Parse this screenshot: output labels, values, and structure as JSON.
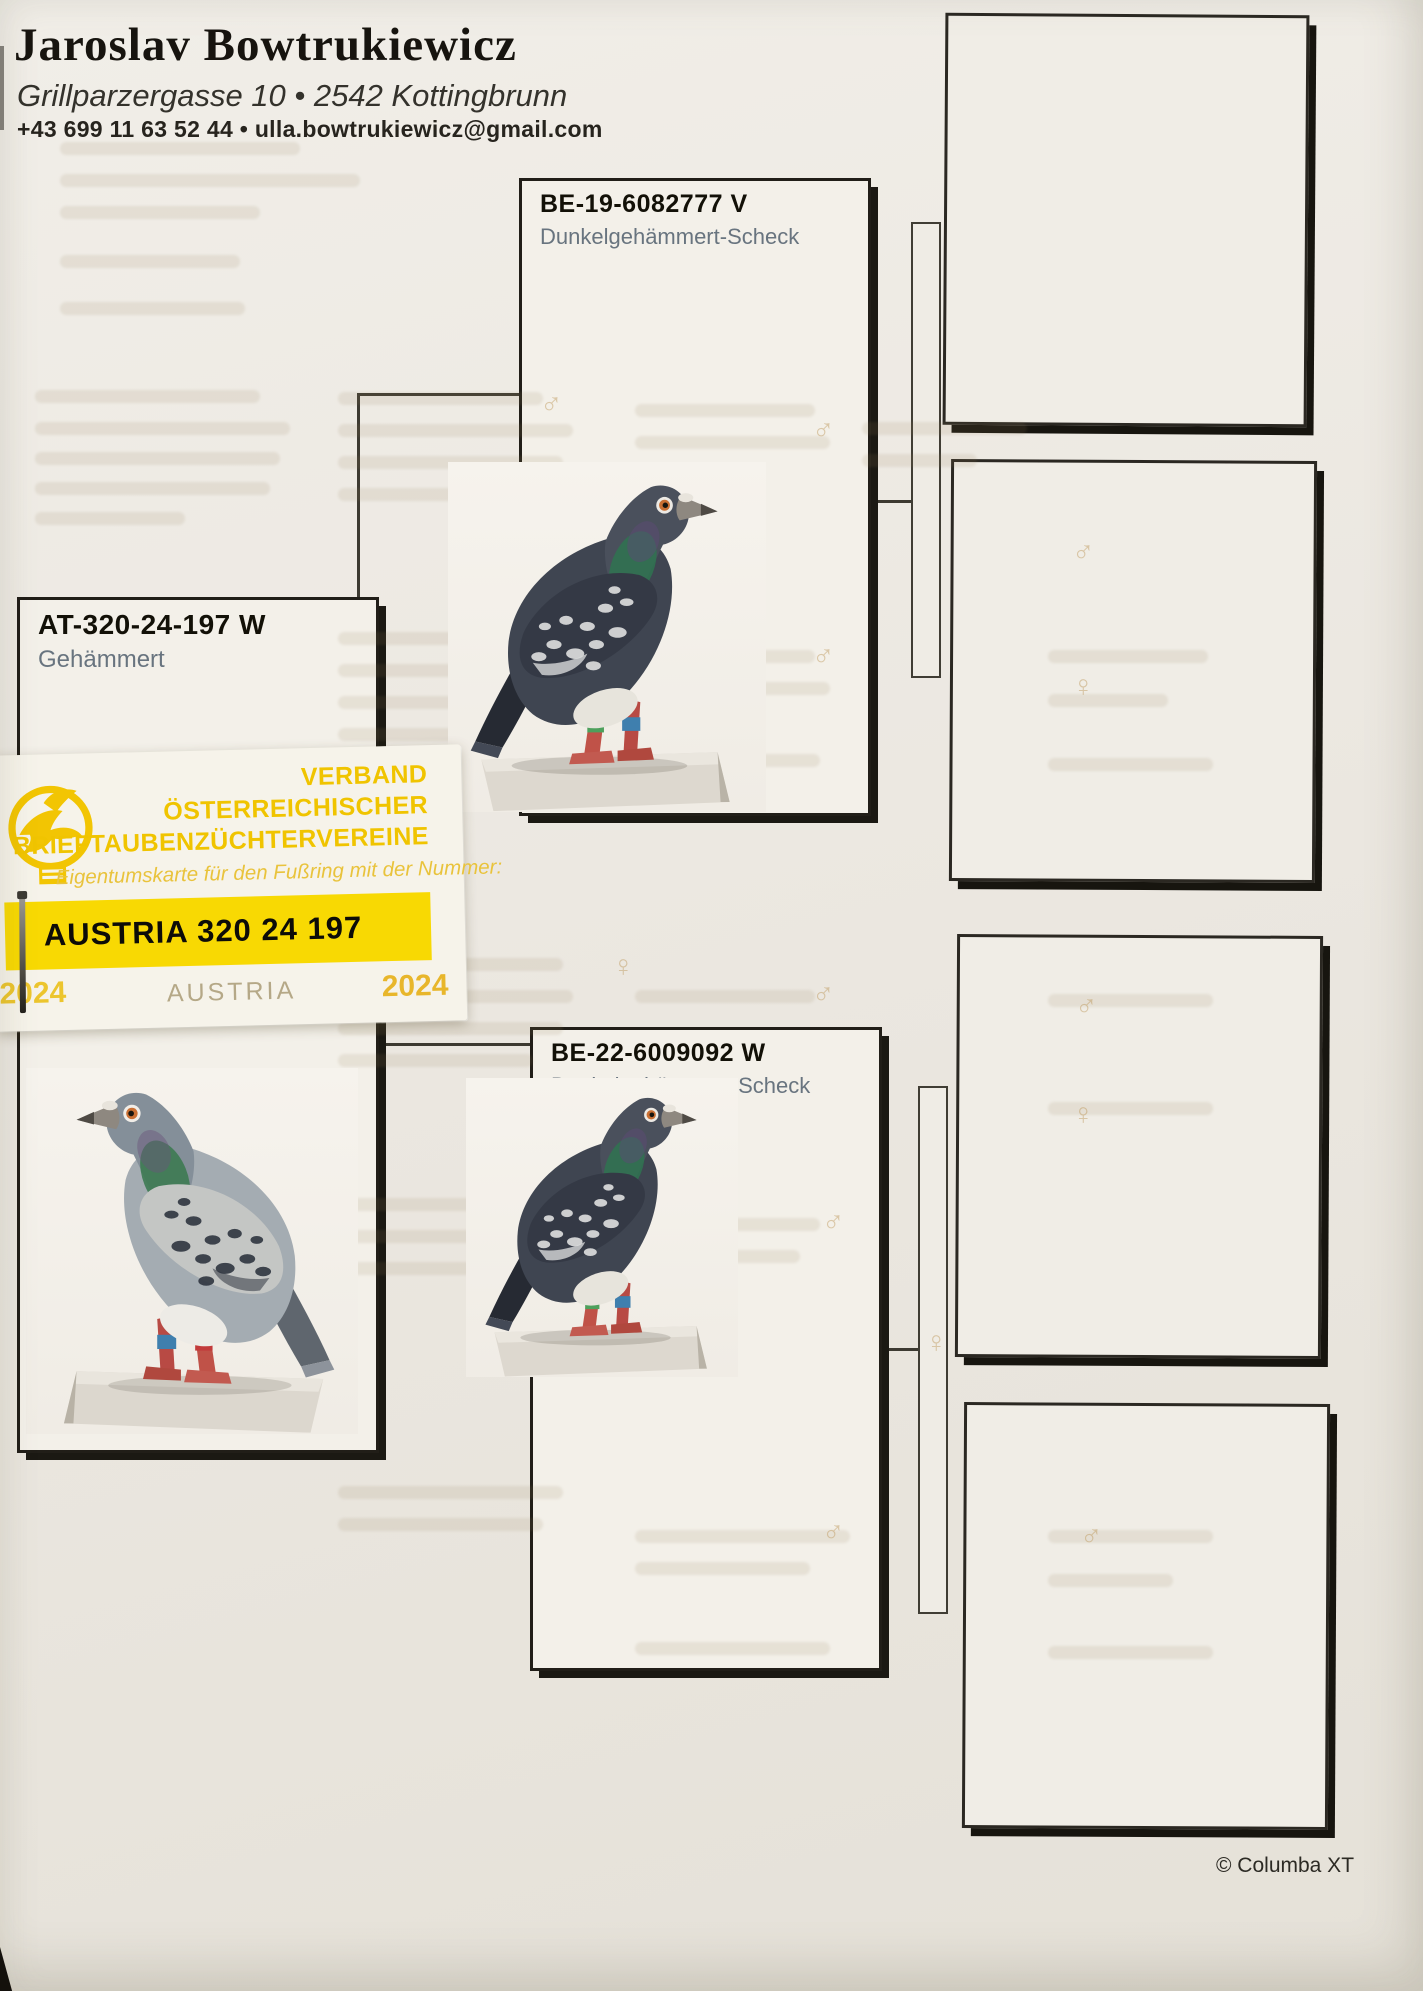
{
  "owner": {
    "name": "Jaroslav Bowtrukiewicz",
    "address": "Grillparzergasse 10 • 2542 Kottingbrunn",
    "contact": "+43 699 11 63 52 44 • ulla.bowtrukiewicz@gmail.com"
  },
  "cards": {
    "main": {
      "ring": "AT-320-24-197 W",
      "variety": "Gehämmert"
    },
    "father": {
      "ring": "BE-19-6082777 V",
      "variety": "Dunkelgehämmert-Scheck"
    },
    "mother": {
      "ring": "BE-22-6009092 W",
      "variety": "Dunkelgehämmert-Scheck"
    }
  },
  "ownership_card": {
    "org_line1": "VERBAND",
    "org_line2": "ÖSTERREICHISCHER",
    "org_line3": "BRIEFTAUBENZÜCHTERVEREINE",
    "subtitle": "Eigentumskarte für den Fußring mit der Nummer:",
    "ring_number": "AUSTRIA 320 24 197",
    "year_left": "2024",
    "country": "AUSTRIA",
    "year_right": "2024"
  },
  "footer": {
    "copyright": "© Columba XT"
  },
  "ghost_symbols": [
    "♂",
    "♂",
    "♀",
    "♂",
    "♂",
    "♀",
    "♀",
    "♂",
    "♂",
    "♀",
    "♂",
    "♀",
    "♂",
    "♂"
  ],
  "colors": {
    "accent_yellow": "#f8d903",
    "ring_text": "#121007",
    "variety_text": "#68747f",
    "paper": "#edeae3"
  }
}
